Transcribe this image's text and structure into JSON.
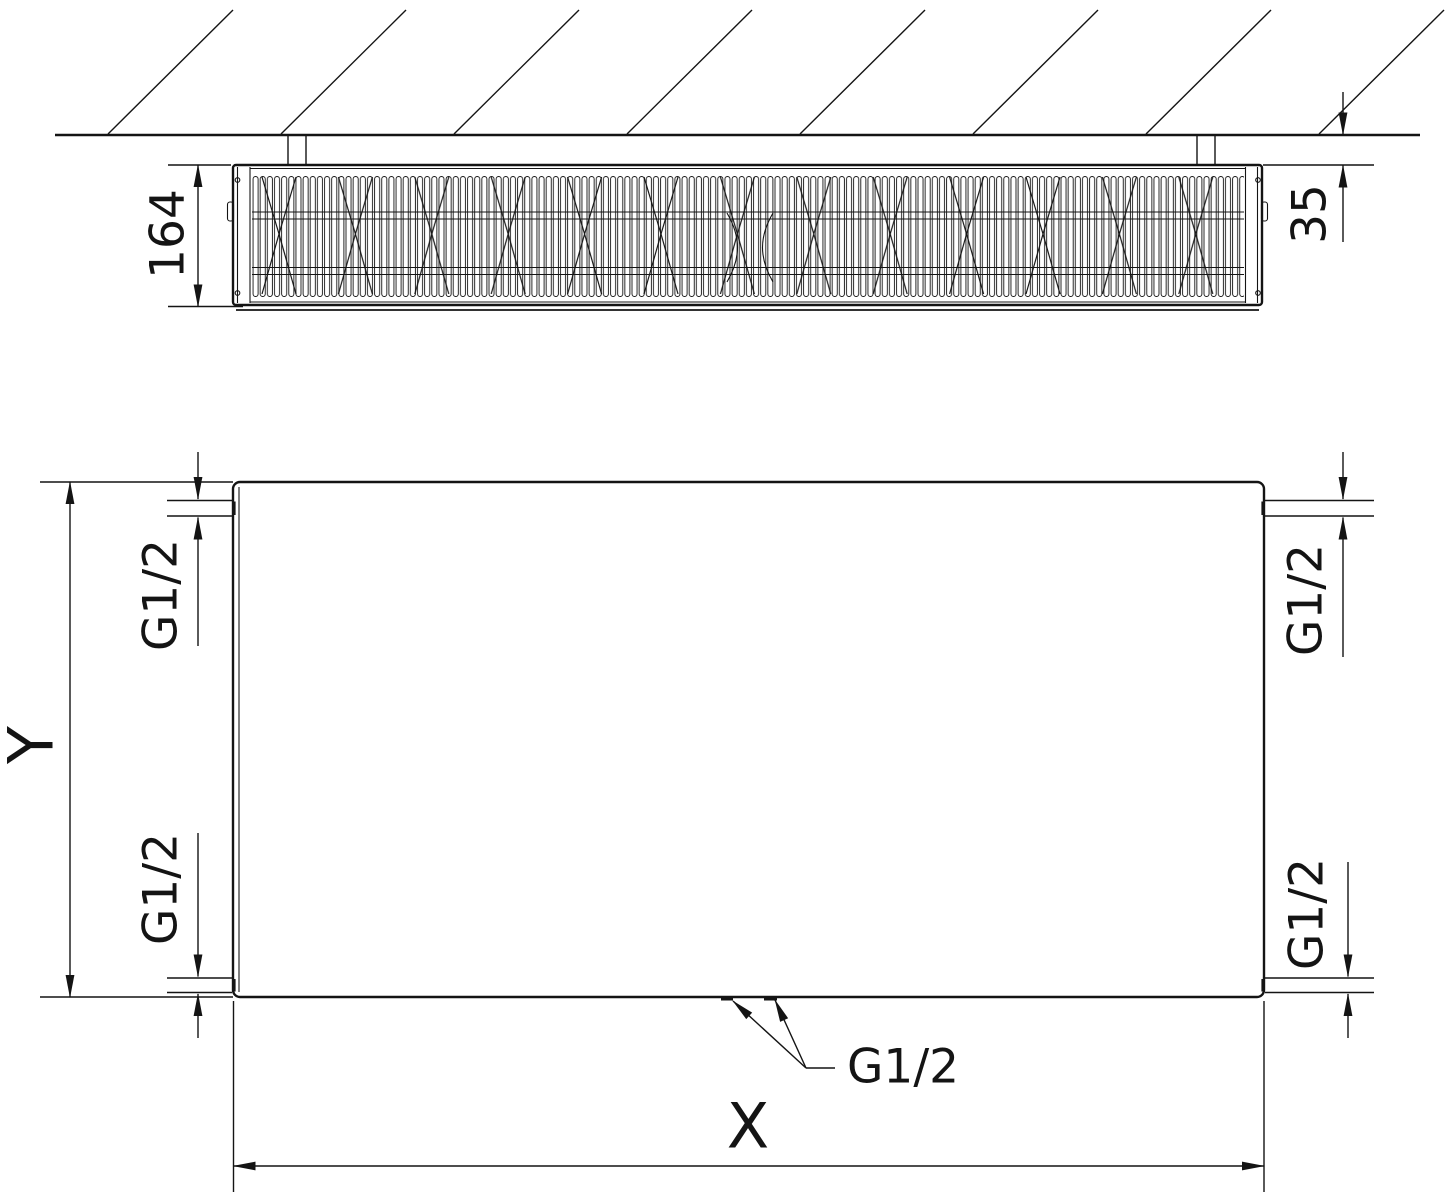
{
  "drawing": {
    "background_color": "#ffffff",
    "line_color": "#141414",
    "top_view": {
      "depth_label": "164",
      "wall_gap_label": "35"
    },
    "front_view": {
      "height_label": "Y",
      "width_label": "X",
      "connections": {
        "top_left": "G1/2",
        "bottom_left": "G1/2",
        "top_right": "G1/2",
        "bottom_right": "G1/2",
        "bottom_center": "G1/2"
      }
    }
  }
}
